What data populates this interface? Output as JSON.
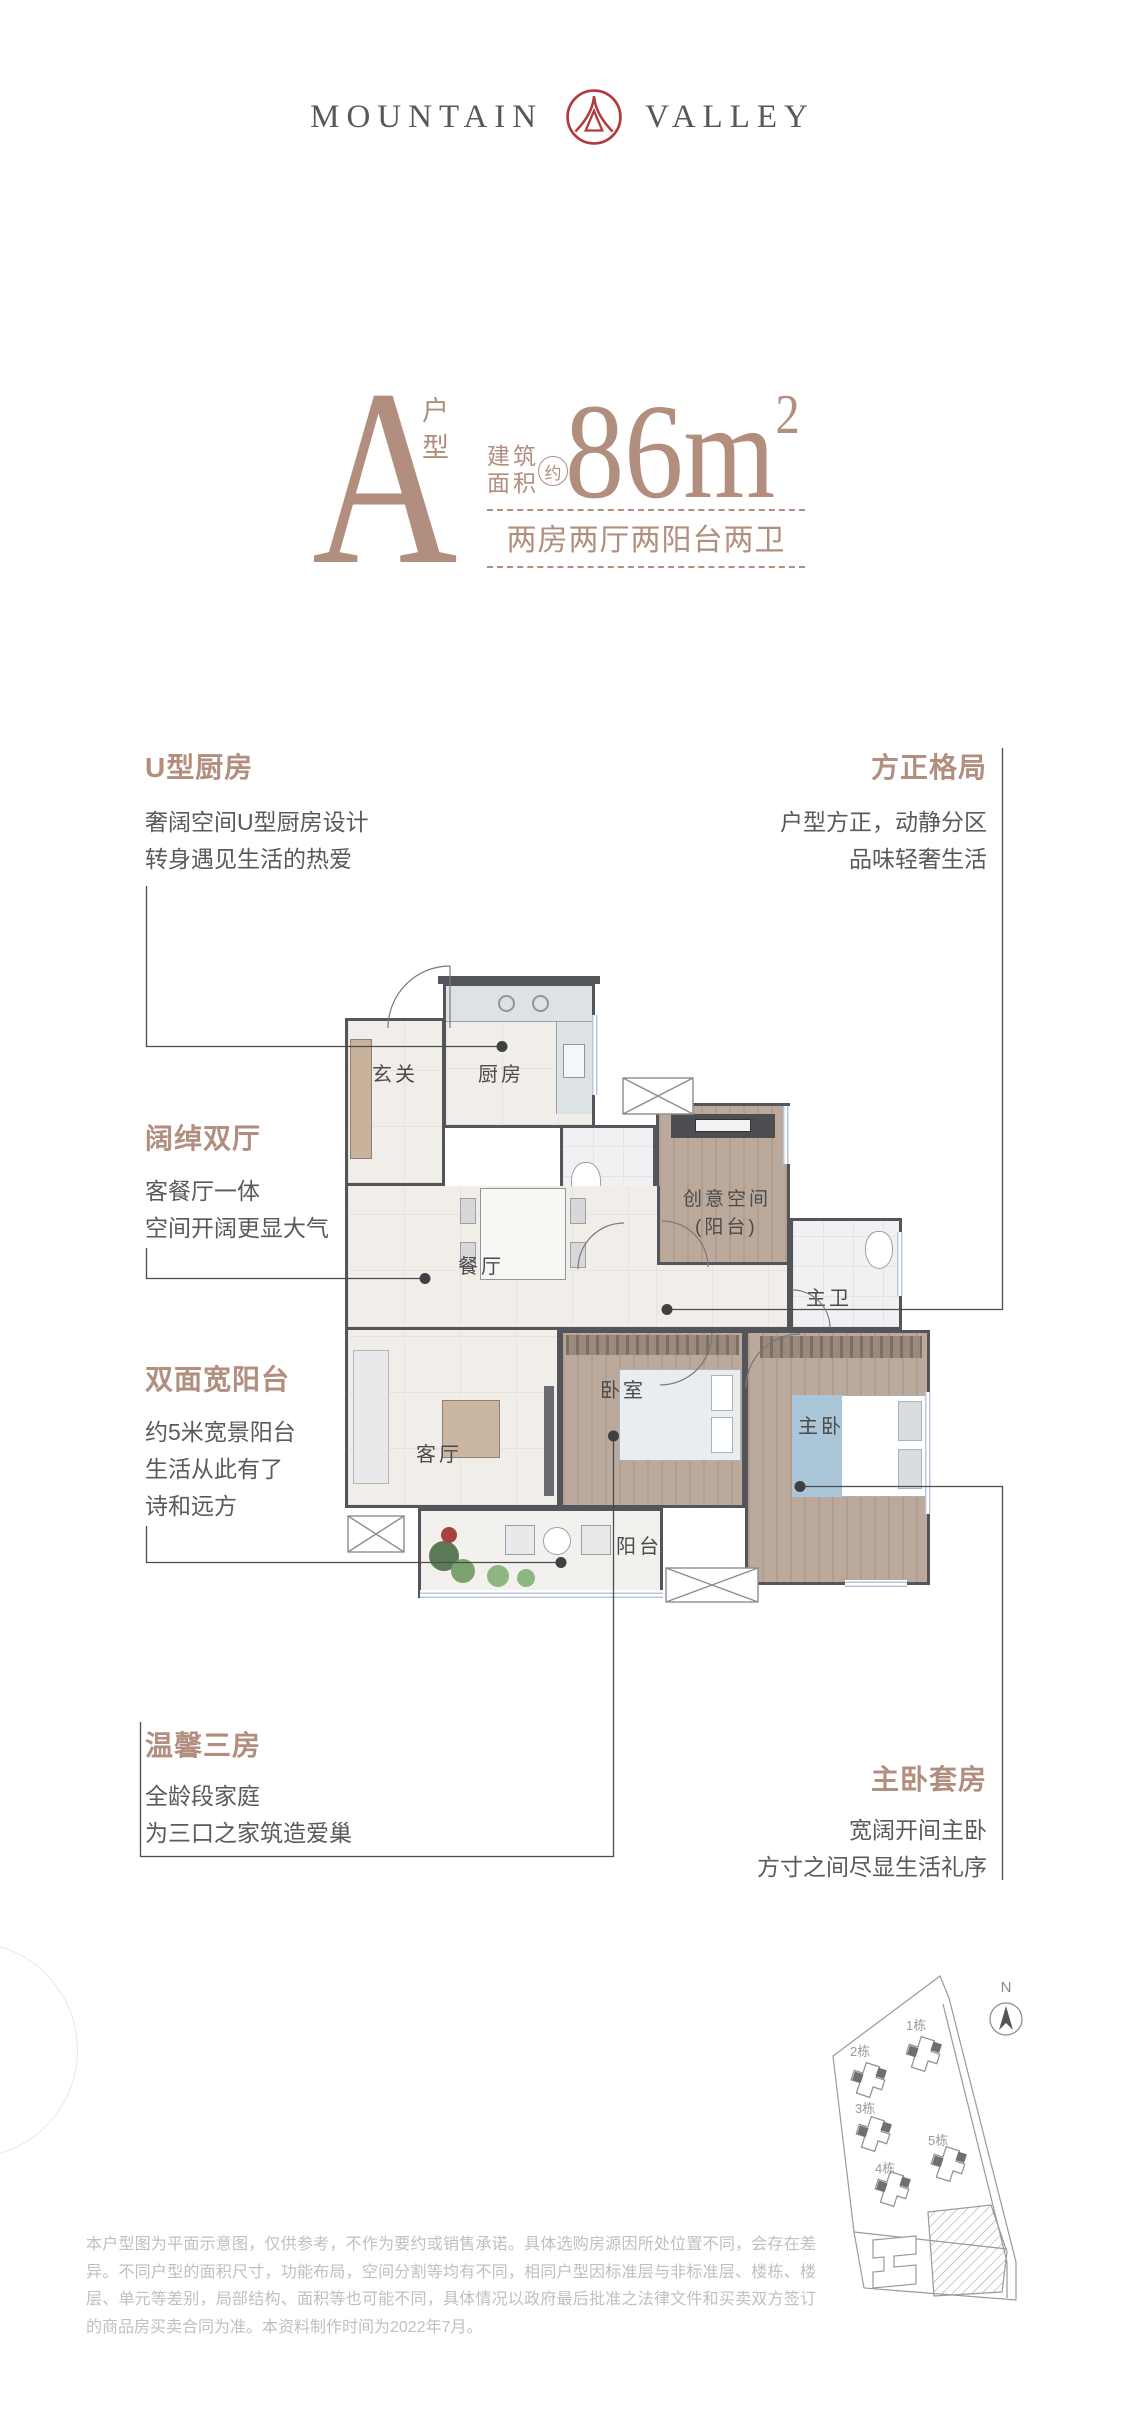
{
  "logo": {
    "word_left": "MOUNTAIN",
    "word_right": "VALLEY"
  },
  "unit": {
    "letter": "A",
    "type_label": "户型",
    "area_label_line1": "建筑",
    "area_label_line2": "面积",
    "approx_badge": "约",
    "area_number": "86m",
    "area_superscript": "2",
    "layout_summary": "两房两厅两阳台两卫"
  },
  "features": [
    {
      "title": "U型厨房",
      "lines": [
        "奢阔空间U型厨房设计",
        "转身遇见生活的热爱"
      ]
    },
    {
      "title": "方正格局",
      "lines": [
        "户型方正，动静分区",
        "品味轻奢生活"
      ]
    },
    {
      "title": "阔绰双厅",
      "lines": [
        "客餐厅一体",
        "空间开阔更显大气"
      ]
    },
    {
      "title": "双面宽阳台",
      "lines": [
        "约5米宽景阳台",
        "生活从此有了",
        "诗和远方"
      ]
    },
    {
      "title": "温馨三房",
      "lines": [
        "全龄段家庭",
        "为三口之家筑造爱巢"
      ]
    },
    {
      "title": "主卧套房",
      "lines": [
        "宽阔开间主卧",
        "方寸之间尽显生活礼序"
      ]
    }
  ],
  "floorplan": {
    "rooms": {
      "entry": "玄关",
      "kitchen": "厨房",
      "bath": "卫",
      "creative_line1": "创意空间",
      "creative_line2": "(阳台)",
      "master_bath": "主卫",
      "dining": "餐厅",
      "living": "客厅",
      "bedroom": "卧室",
      "master": "主卧",
      "balcony": "阳台"
    }
  },
  "siteplan": {
    "north_label": "N",
    "buildings": [
      "1栋",
      "2栋",
      "3栋",
      "4栋",
      "5栋"
    ]
  },
  "disclaimer": "本户型图为平面示意图，仅供参考，不作为要约或销售承诺。具体选购房源因所处位置不同，会存在差异。不同户型的面积尺寸，功能布局，空间分割等均有不同，相同户型因标准层与非标准层、楼栋、楼层、单元等差别，局部结构、面积等也可能不同，具体情况以政府最后批准之法律文件和买卖双方签订的商品房买卖合同为准。本资料制作时间为2022年7月。",
  "colors": {
    "accent": "#b28e7f",
    "logo_red": "#b23a3c",
    "wall": "#54555a",
    "body_text": "#595a5c",
    "disclaimer_text": "#c2bfbd"
  }
}
